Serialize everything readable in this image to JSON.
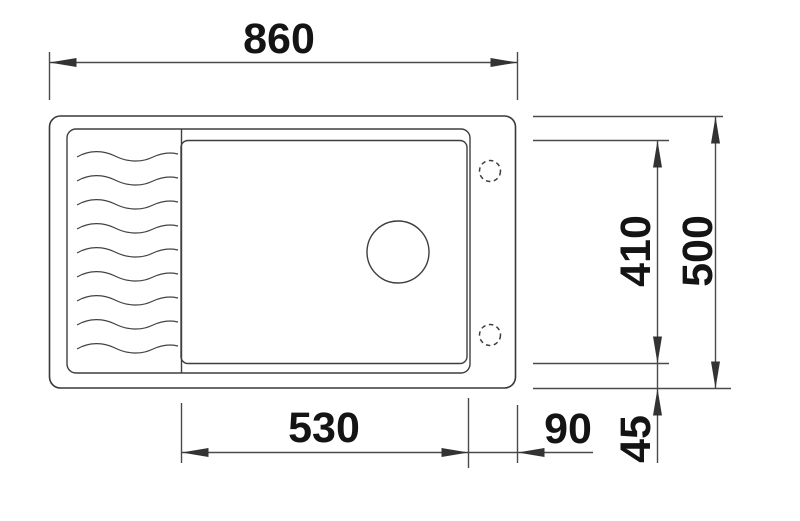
{
  "drawing": {
    "type": "technical-dimension-drawing",
    "subject": "sink-top-view",
    "background_color": "#ffffff",
    "outline_color": "#383838",
    "dimension_line_color": "#4a4a4a",
    "label_color": "#141414"
  },
  "dimensions": {
    "overall_width": {
      "label": "860"
    },
    "overall_depth": {
      "label": "500"
    },
    "bowl_depth": {
      "label": "410"
    },
    "bowl_width": {
      "label": "530"
    },
    "bowl_to_edge": {
      "label": "90"
    },
    "bowl_to_bottom": {
      "label": "45"
    }
  },
  "features": {
    "drainboard_wave_count": 9,
    "tap_hole_count": 2,
    "drain_hole_count": 1
  }
}
